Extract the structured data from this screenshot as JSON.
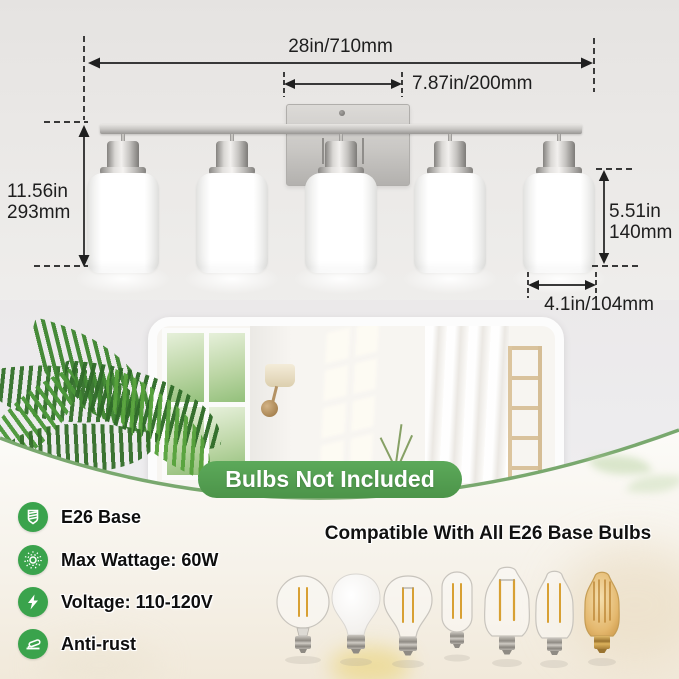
{
  "diagram": {
    "overall_width": "28in/710mm",
    "center_spacing": "7.87in/200mm",
    "overall_height": {
      "line1": "11.56in",
      "line2": "293mm"
    },
    "shade_height": {
      "line1": "5.51in",
      "line2": "140mm"
    },
    "shade_width": "4.1in/104mm"
  },
  "badge": {
    "label": "Bulbs Not Included"
  },
  "features": [
    {
      "icon": "e26-base-icon",
      "label": "E26 Base"
    },
    {
      "icon": "max-wattage-icon",
      "label": "Max Wattage: 60W"
    },
    {
      "icon": "voltage-icon",
      "label": "Voltage: 110-120V"
    },
    {
      "icon": "anti-rust-icon",
      "label": "Anti-rust"
    }
  ],
  "compatibility": {
    "title": "Compatible With All E26 Base Bulbs",
    "bulbs": [
      "globe-filament-bulb",
      "frosted-a19-bulb",
      "a19-filament-bulb",
      "tubular-filament-bulb",
      "st64-filament-bulb",
      "st58-filament-bulb",
      "amber-edison-bulb"
    ]
  },
  "colors": {
    "accent_green": "#3aa34c",
    "badge_green": "#539c52",
    "curve_green": "#79a86e",
    "dimension_line": "#1f1f1f",
    "nickel": "#c9c7c4"
  }
}
